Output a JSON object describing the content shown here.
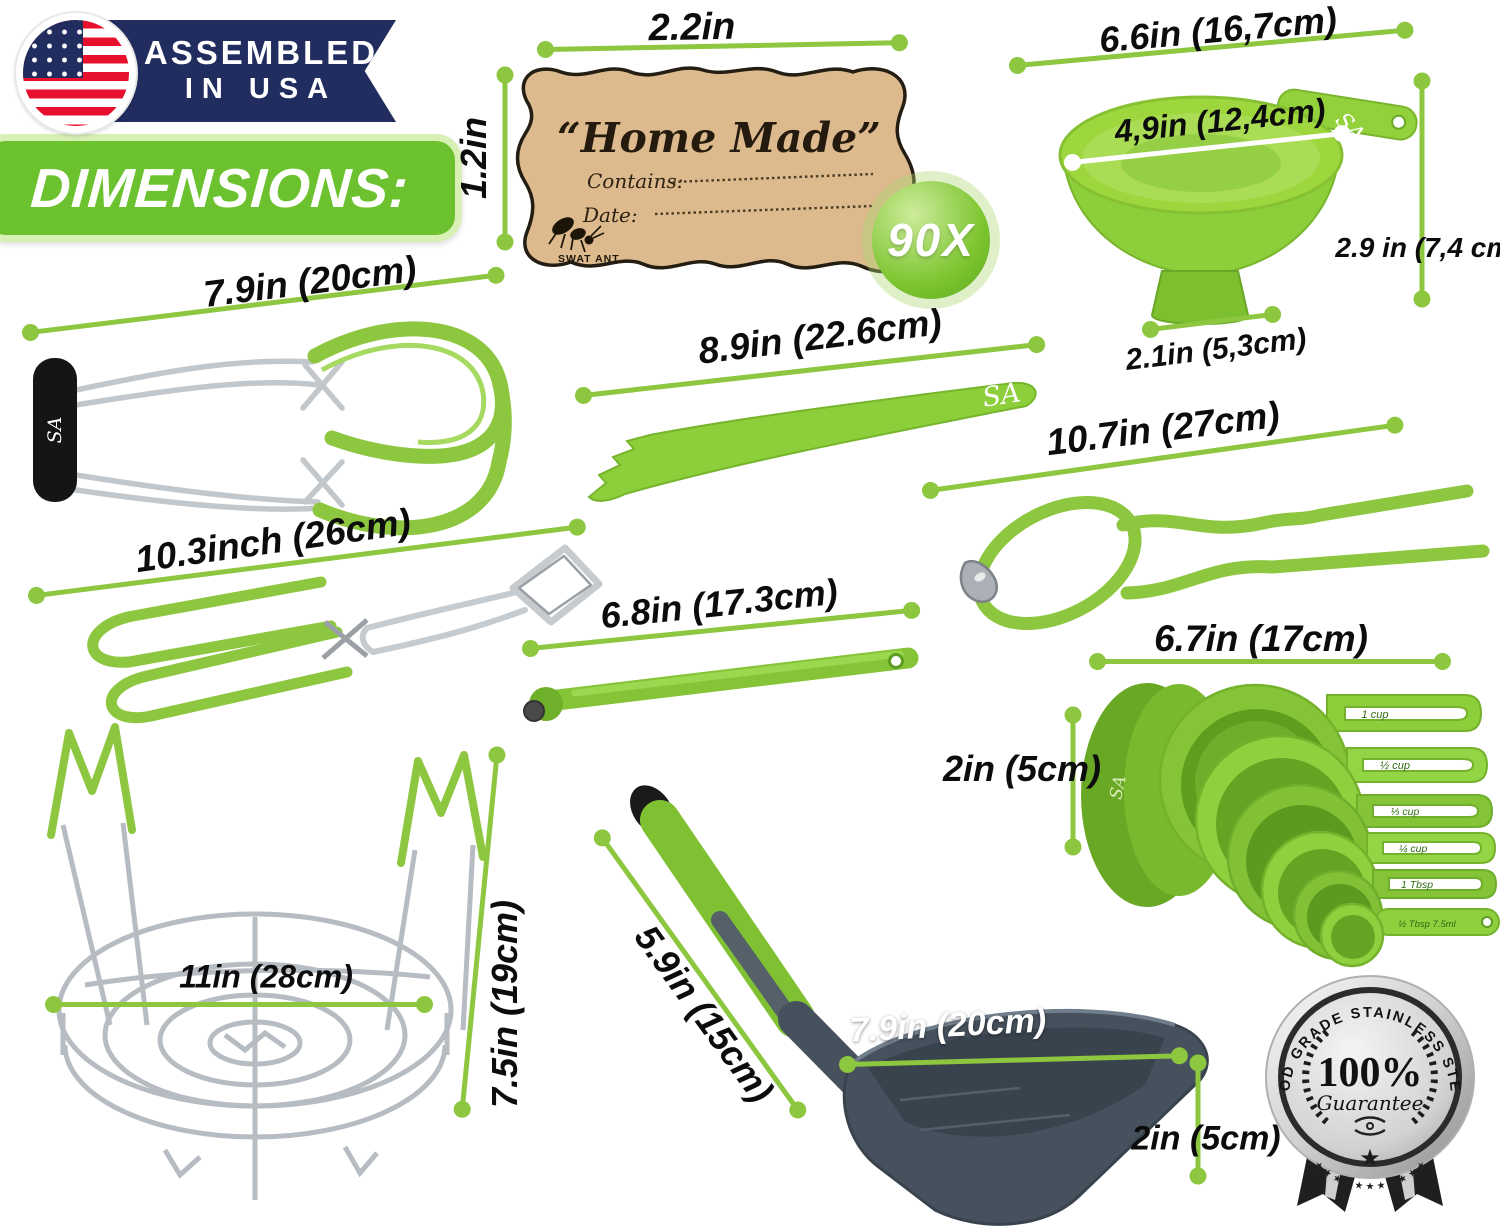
{
  "colors": {
    "accent_green": "#8dc63f",
    "tool_green": "#8ccf3a",
    "navy": "#212c5f",
    "banner_green": "#6cc22e",
    "kraft": "#dcba8e",
    "ladle_gray": "#46515d"
  },
  "header": {
    "assembled_line1": "ASSEMBLED",
    "assembled_line2": "IN USA",
    "dimensions_title": "DIMENSIONS:"
  },
  "label_tag": {
    "title": "“Home Made”",
    "contains_label": "Contains:",
    "date_label": "Date:",
    "brand_name": "SWAT ANT",
    "count_badge": "90X"
  },
  "brand_initials": "SA",
  "dims": {
    "label_width": "2.2in",
    "label_height": "1.2in",
    "funnel_top": "6.6in (16,7cm)",
    "funnel_inner": "4,9in (12,4cm)",
    "funnel_height": "2.9 in (7,4 cm)",
    "funnel_bottom": "2.1in (5,3cm)",
    "jar_lifter": "7.9in (20cm)",
    "bubble_knife": "8.9in (22.6cm)",
    "jar_wrench": "10.7in (27cm)",
    "tongs": "10.3inch (26cm)",
    "lid_lifter": "6.8in (17.3cm)",
    "cups_length": "6.7in (17cm)",
    "cups_height": "2in (5cm)",
    "rack_diameter": "11in (28cm)",
    "rack_height": "7.5in (19cm)",
    "ladle_handle": "5.9in (15cm)",
    "ladle_scoop": "7.9in (20cm)",
    "ladle_depth": "2in (5cm)"
  },
  "measuring_cups": {
    "sizes": [
      "1 cup",
      "½ cup",
      "⅓ cup",
      "¼ cup",
      "1 Tbsp",
      "½ Tbsp 7.5ml"
    ]
  },
  "medal": {
    "arc_text": "FOOD GRADE STAINLESS STEEL",
    "stars": "★ ★ ★ ★ ★ ★ ★ ★ ★ ★ ★",
    "percent": "100%",
    "script": "Guarantee",
    "star": "★"
  }
}
